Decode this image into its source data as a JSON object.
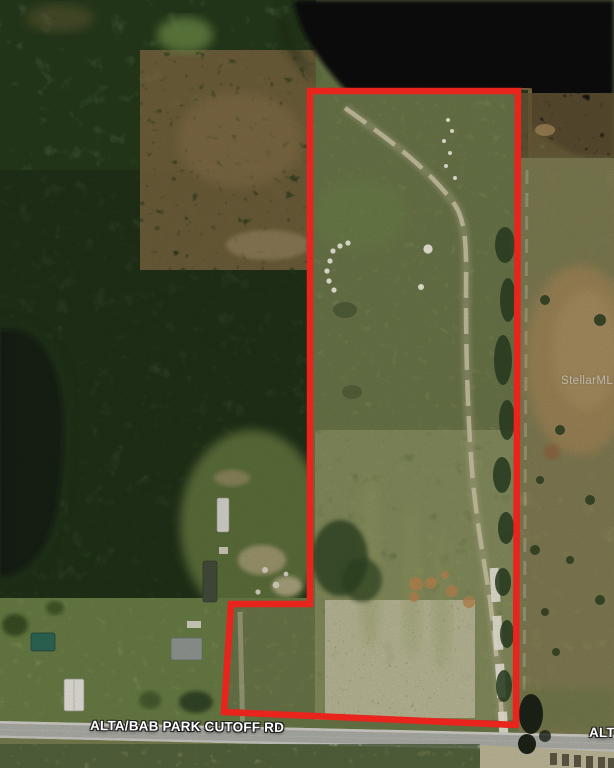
{
  "meta": {
    "description": "Aerial satellite photo of a vacant land parcel outlined in red, bordered by a lake to the north and a rural road to the south",
    "width_px": 614,
    "height_px": 768
  },
  "road": {
    "name": "ALTA/BAB PARK CUTOFF RD",
    "name_partial_right": "ALT"
  },
  "watermark": {
    "text": "StellarMLS"
  },
  "parcel": {
    "boundary_points": "310,91 518,91 516,725 224,712 231,604 310,604",
    "outline_width": 6.5
  },
  "colors": {
    "boundary_red": "#e8241d",
    "label_text": "#ffffff",
    "label_outline": "#1c1c1c",
    "water_dark": "#0b0f09",
    "woods_green": "#47603a",
    "pasture_green": "#7e8655",
    "dry_field_tan": "#958a5f",
    "road_gray": "#b4b4ae",
    "sand_trail": "#d6cfae"
  }
}
